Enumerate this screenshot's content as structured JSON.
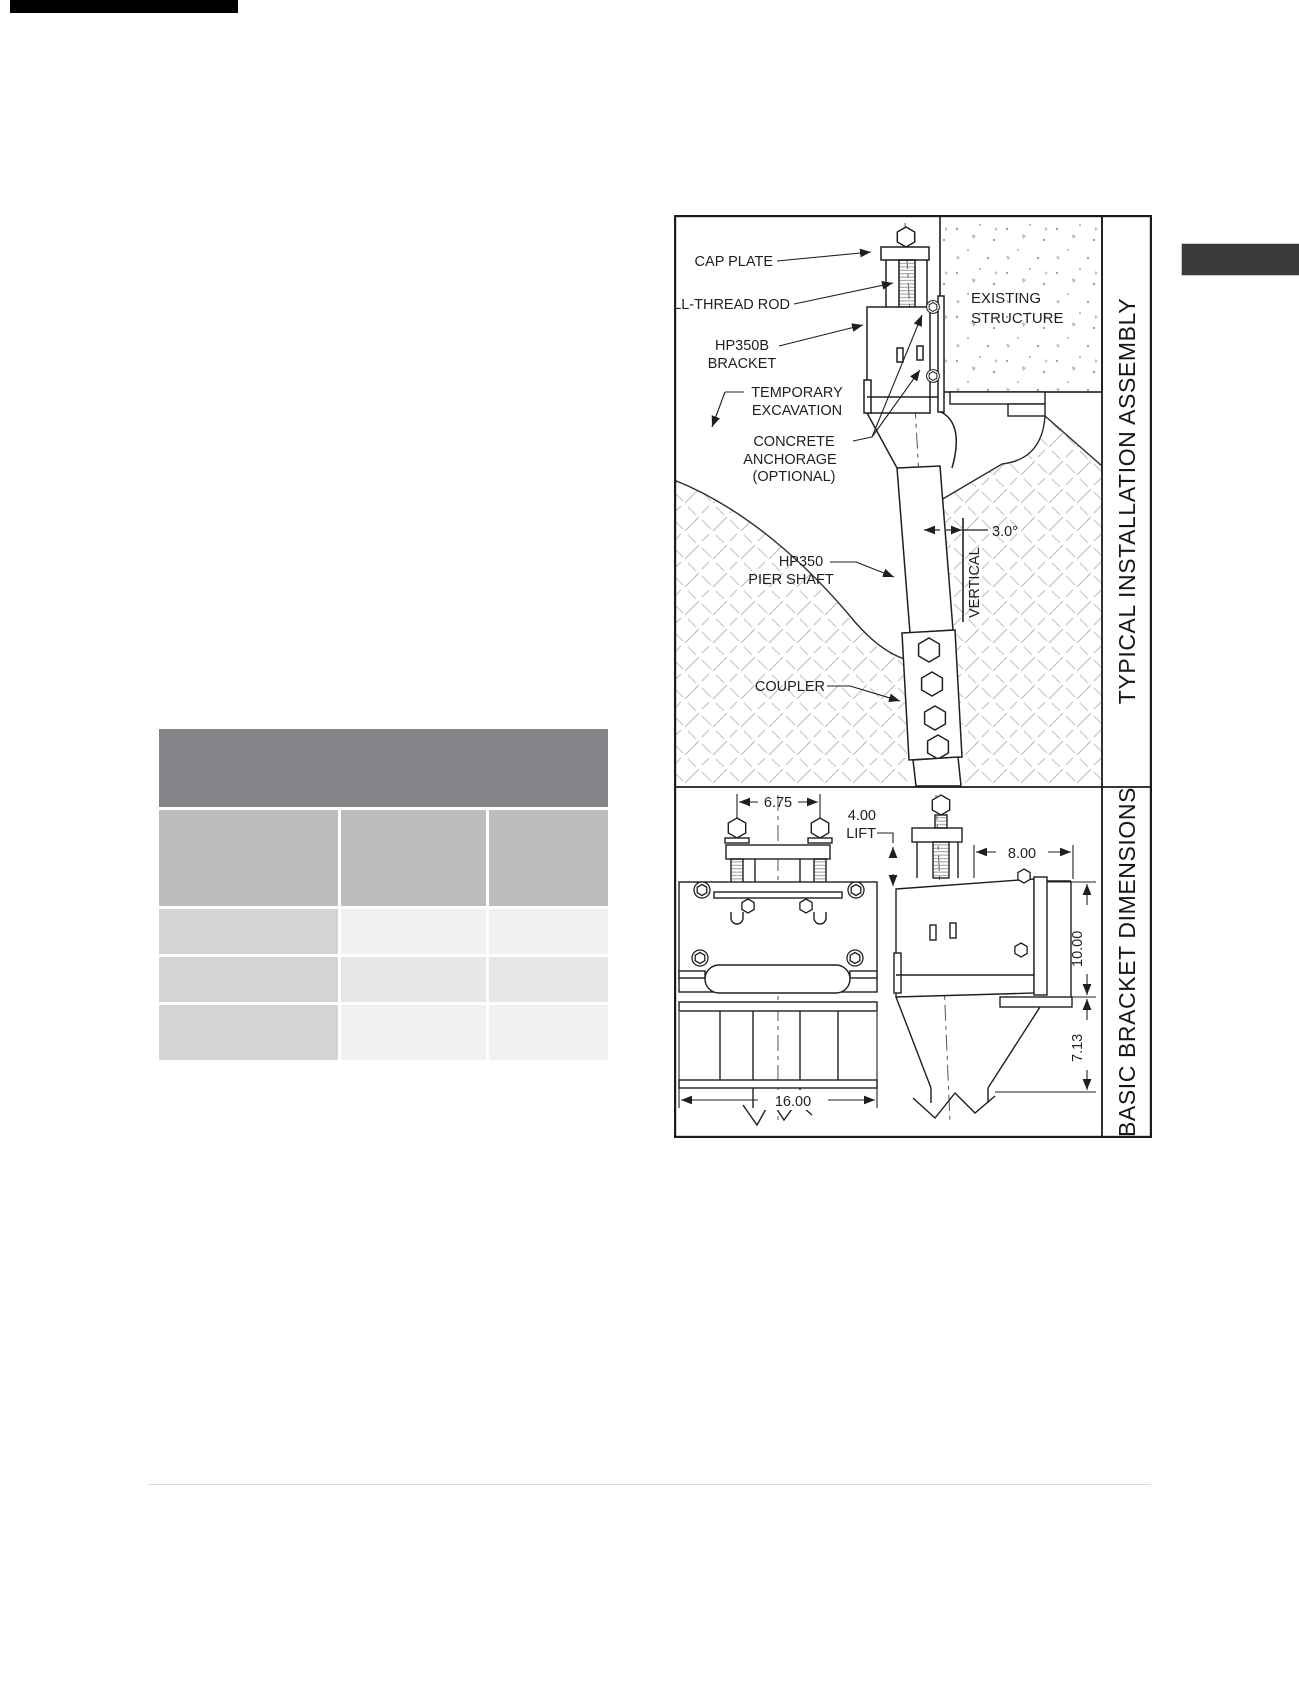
{
  "decorations": {
    "top_bar_color": "#000000",
    "corner_tab_color": "#3a3a3c",
    "footer_rule_color": "#d9d9d9"
  },
  "table": {
    "header_label": "",
    "column_labels": [
      "",
      "",
      ""
    ],
    "rows": [
      [
        "",
        "",
        ""
      ],
      [
        "",
        "",
        ""
      ],
      [
        "",
        "",
        ""
      ]
    ],
    "colors": {
      "header": "#828488",
      "column_header": "#bcbdbf",
      "row_label_col": "#d3d4d6",
      "cell_light": "#f1f1f2",
      "cell_mid": "#e6e7e9"
    }
  },
  "assembly_panel": {
    "title": "TYPICAL INSTALLATION ASSEMBLY",
    "labels": {
      "cap_plate": "CAP PLATE",
      "all_thread_rod": "ALL-THREAD ROD",
      "bracket_line1": "HP350B",
      "bracket_line2": "BRACKET",
      "excavation_line1": "TEMPORARY",
      "excavation_line2": "EXCAVATION",
      "anchorage_line1": "CONCRETE",
      "anchorage_line2": "ANCHORAGE",
      "anchorage_line3": "(OPTIONAL)",
      "structure_line1": "EXISTING",
      "structure_line2": "STRUCTURE",
      "pier_line1": "HP350",
      "pier_line2": "PIER SHAFT",
      "coupler": "COUPLER",
      "batter_angle": "3.0°",
      "vertical_ref": "VERTICAL"
    }
  },
  "dimensions_panel": {
    "title": "BASIC BRACKET DIMENSIONS",
    "dims": {
      "rod_spacing": "6.75",
      "lift_line1": "4.00",
      "lift_line2": "LIFT",
      "bracket_depth": "8.00",
      "bracket_height": "10.00",
      "heel_drop": "7.13",
      "bracket_width": "16.00"
    }
  }
}
